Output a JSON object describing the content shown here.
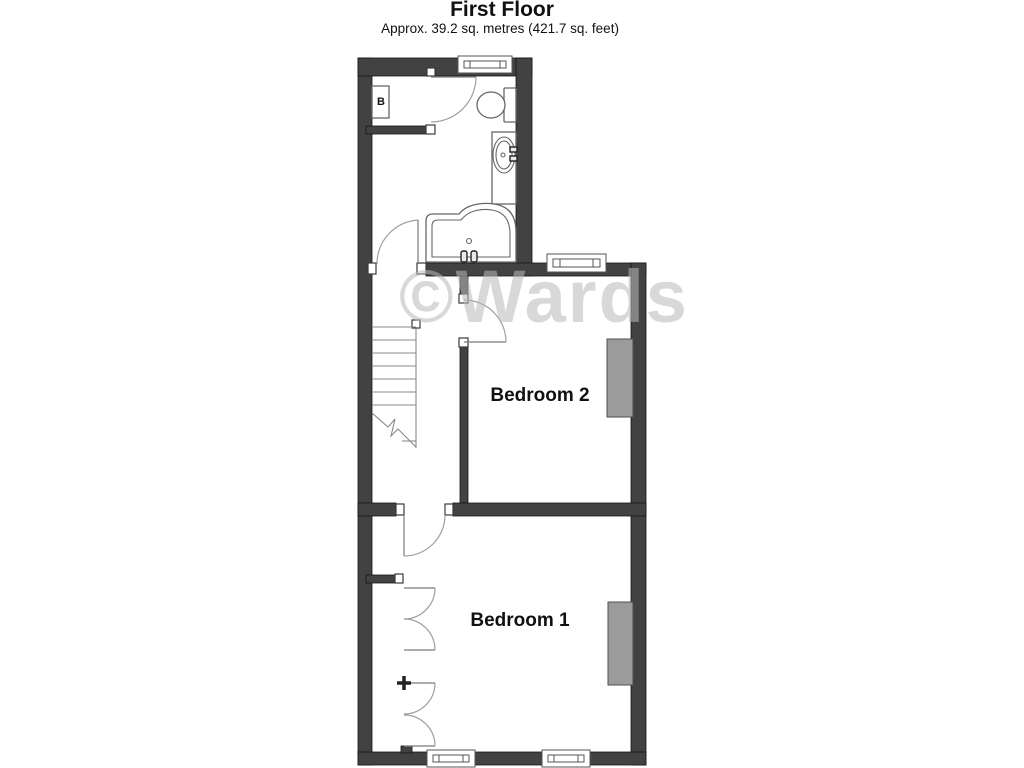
{
  "header": {
    "title": "First Floor",
    "subtitle": "Approx. 39.2 sq. metres (421.7 sq. feet)"
  },
  "watermark": "©Wards",
  "rooms": [
    {
      "name": "Bedroom 2"
    },
    {
      "name": "Bedroom 1"
    }
  ],
  "fixtures": {
    "boiler_label": "B",
    "bathroom_items": [
      "toilet",
      "basin",
      "bath"
    ],
    "features": [
      "stairs",
      "wardrobe-doors",
      "chimney-breast-bedroom2",
      "chimney-breast-bedroom1"
    ]
  },
  "colors": {
    "wall": "#424242",
    "line": "#666666",
    "arc": "#9f9f9f",
    "chimney": "#9b9b9b",
    "text": "#111111",
    "watermark": "#bababa"
  }
}
